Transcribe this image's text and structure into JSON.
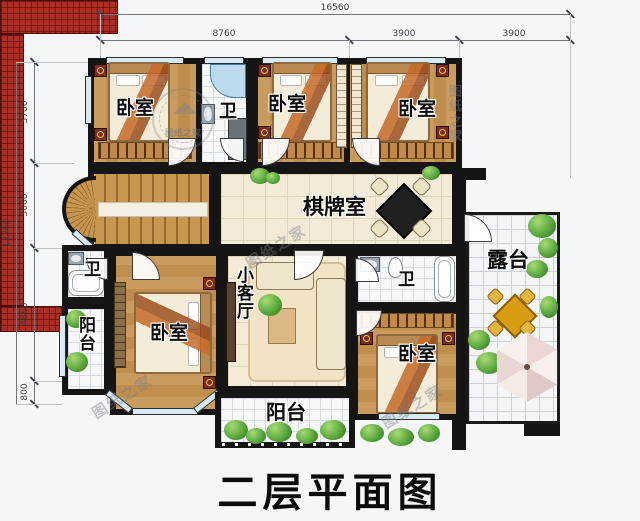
{
  "title": "二层平面图",
  "watermark": "图纸之家",
  "dimensions": {
    "top_total": "16560",
    "top_segments": [
      "8760",
      "3900",
      "3900"
    ],
    "left_total": "12360",
    "left_segments": [
      "3700",
      "3000",
      "4860",
      "800"
    ]
  },
  "rooms": {
    "bedroom_top_left": "卧室",
    "bath_top": "卫",
    "bedroom_top_middle": "卧室",
    "bedroom_top_right": "卧室",
    "game_room": "棋牌室",
    "terrace": "露台",
    "bath_left": "卫",
    "balcony_left": "阳台",
    "bedroom_bottom_left": "卧室",
    "small_living_room": "小客厅",
    "bath_right": "卫",
    "bedroom_bottom_right": "卧室",
    "balcony_bottom": "阳台"
  },
  "colors": {
    "wall": "#151515",
    "wood_floor": "#c99c5e",
    "tile_beige": "#f3ead7",
    "tile_white": "#f6f7f8",
    "roof_red": "#ac2e24",
    "greenery": "#5aa83e",
    "game_table": "#202020",
    "umbrella_pink": "#ead6d4"
  }
}
